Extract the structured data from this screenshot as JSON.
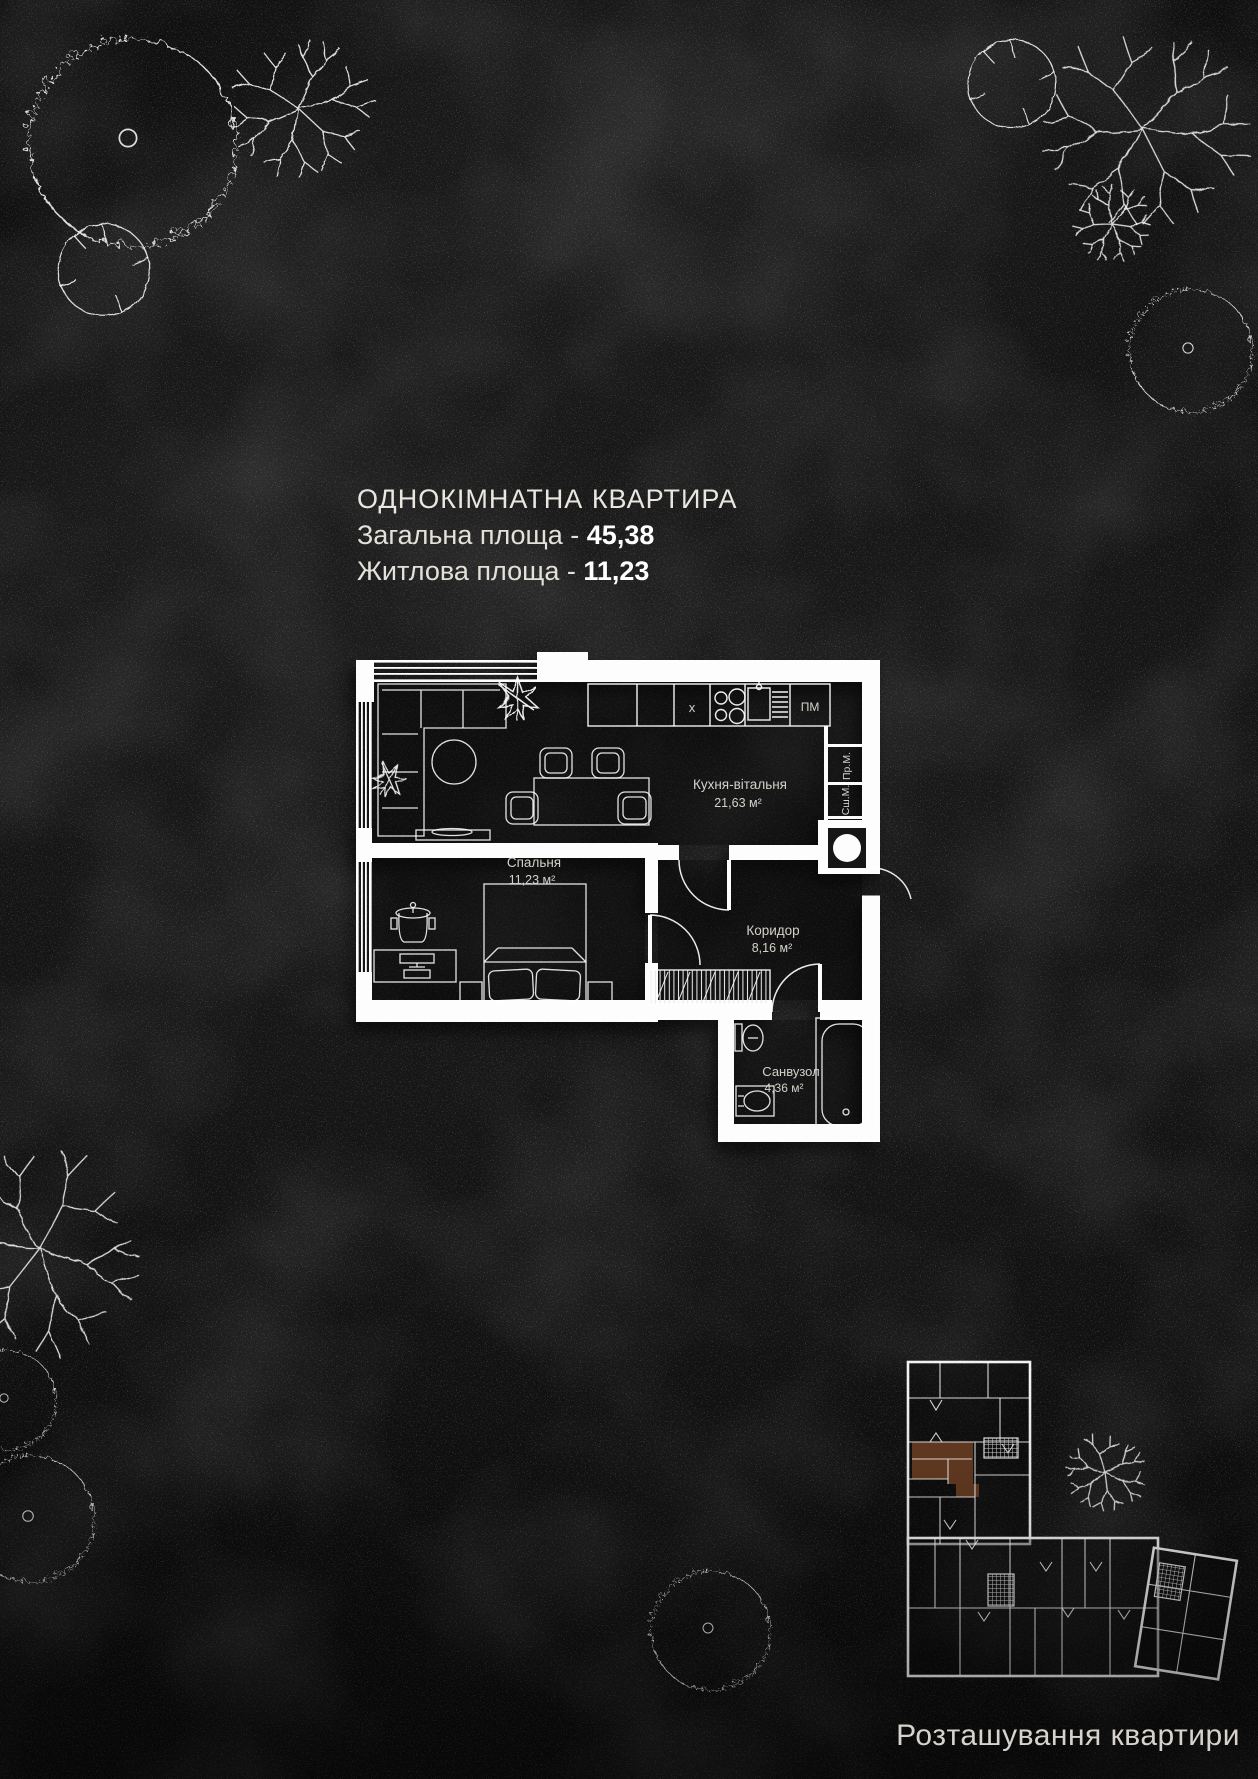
{
  "header": {
    "title": "ОДНОКІМНАТНА КВАРТИРА",
    "total_label": "Загальна площа -",
    "total_value": "45,38",
    "living_label": "Житлова площа -",
    "living_value": "11,23"
  },
  "plan": {
    "rooms": [
      {
        "name": "Кухня-вітальня",
        "area": "21,63 м²"
      },
      {
        "name": "Спальня",
        "area": "11,23 м²"
      },
      {
        "name": "Коридор",
        "area": "8,16 м²"
      },
      {
        "name": "Санвузол",
        "area": "4,36 м²"
      }
    ],
    "appliances": {
      "dishwasher": "ПМ",
      "washer": "Пр.М.",
      "dryer": "Сш.М.",
      "vent_mark": "x"
    }
  },
  "location": {
    "caption": "Розташування квартири"
  },
  "colors": {
    "background": "#131313",
    "walls": "#ffffff",
    "text": "#e8e4dd",
    "highlight": "#96572f"
  }
}
